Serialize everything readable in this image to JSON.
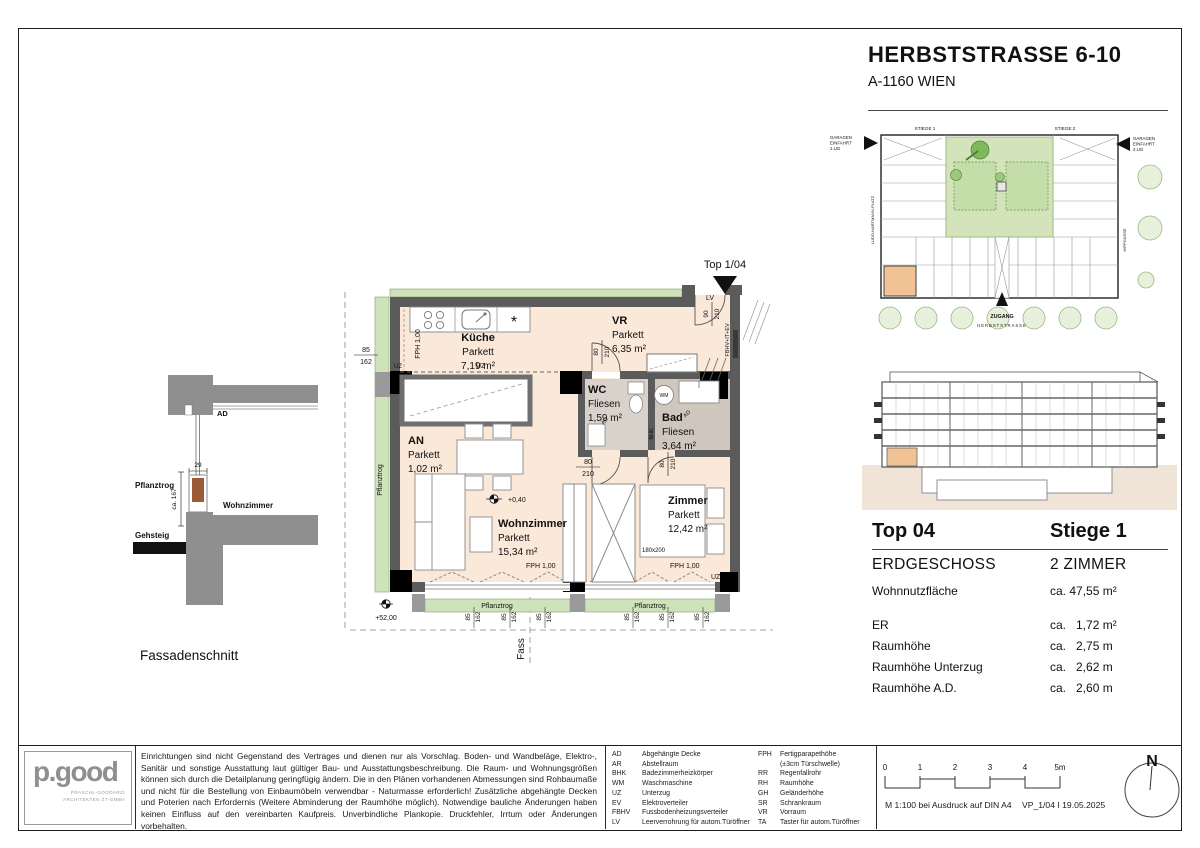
{
  "header": {
    "title": "HERBSTSTRASSE 6-10",
    "subtitle": "A-1160 WIEN"
  },
  "site_plan": {
    "stiege1": "STIEGE 1",
    "stiege2": "STIEGE 2",
    "garage_left": [
      "GARAGEN",
      "EINFAHRT",
      "1.UG"
    ],
    "garage_right": [
      "GARAGEN",
      "EINFAHRT",
      "2.UG"
    ],
    "street_left": "LUDO-HARTMANN-PLATZ",
    "street_right": "HIPPGASSE",
    "zugang": "ZUGANG",
    "street_bottom": "HERBSTSTRASSE"
  },
  "plan": {
    "unit_label": "Top 1/04",
    "rooms": {
      "kueche": {
        "name": "Küche",
        "floor": "Parkett",
        "area": "7,19 m²"
      },
      "vr": {
        "name": "VR",
        "floor": "Parkett",
        "area": "6,35 m²"
      },
      "wc": {
        "name": "WC",
        "floor": "Fliesen",
        "area": "1,59 m²"
      },
      "bad": {
        "name": "Bad",
        "floor": "Fliesen",
        "area": "3,64 m²"
      },
      "an": {
        "name": "AN",
        "floor": "Parkett",
        "area": "1,02 m²"
      },
      "wohnzimmer": {
        "name": "Wohnzimmer",
        "floor": "Parkett",
        "area": "15,34 m²"
      },
      "zimmer": {
        "name": "Zimmer",
        "floor": "Parkett",
        "area": "12,42 m²"
      }
    },
    "annotations": {
      "lv": "LV",
      "uz": "UZ",
      "fbhv": "FBHV+IT+EV",
      "fph": "FPH 1,00",
      "wm": "WM",
      "bhk": "BHK",
      "ad": "AD",
      "level": "+0,40",
      "ground": "+52,00",
      "bed_size": "180x200",
      "pflanztrog": "Pflanztrog",
      "fass": "Fass",
      "dim_w": "85",
      "dim_h": "162",
      "door_w": "80",
      "door_h": "210",
      "entry_w": "90",
      "appliance": "*"
    }
  },
  "facade": {
    "caption": "Fassadenschnitt",
    "ad": "AD",
    "pflanztrog": "Pflanztrog",
    "wohnzimmer": "Wohnzimmer",
    "gehsteig": "Gehsteig",
    "dim_width": "29",
    "dim_height": "ca. 167"
  },
  "info": {
    "top": "Top  04",
    "stiege": "Stiege 1",
    "floor": "ERDGESCHOSS",
    "rooms": "2 ZIMMER",
    "area_label": "Wohnnutzfläche",
    "area_value": "ca. 47,55 m²",
    "rows": [
      {
        "label": "ER",
        "value": "ca.   1,72 m²"
      },
      {
        "label": "Raumhöhe",
        "value": "ca.   2,75 m"
      },
      {
        "label": "Raumhöhe Unterzug",
        "value": "ca.   2,62 m"
      },
      {
        "label": "Raumhöhe A.D.",
        "value": "ca.   2,60 m"
      }
    ]
  },
  "footer": {
    "logo": {
      "word": "p.good",
      "line1": "PRASCHL-GOODARZI",
      "line2": "ARCHITEKTEN ZT-GMBH"
    },
    "disclaimer": "Einrichtungen sind nicht Gegenstand des Vertrages und dienen nur als Vorschlag. Boden- und Wandbeläge, Elektro-, Sanitär und sonstige Ausstattung laut gültiger Bau- und Ausstattungsbeschreibung. Die Raum- und Wohnungsgrößen können sich durch die Detailplanung geringfügig ändern. Die in den Plänen vorhandenen Abmessungen sind Rohbaumaße und nicht für die Bestellung von Einbaumöbeln verwendbar - Naturmasse erforderlich! Zusätzliche abgehängte Decken und Poterien nach Erfordernis (Weitere Abminderung der Raumhöhe möglich). Notwendige bauliche Änderungen haben keinen Einfluss auf den vereinbarten Kaufpreis. Unverbindliche Plankopie. Druckfehler, Irrtum oder Änderungen vorbehalten.",
    "abbr_left": [
      [
        "AD",
        "Abgehängte Decke"
      ],
      [
        "AR",
        "Abstellraum"
      ],
      [
        "BHK",
        "Badezimmerheizkörper"
      ],
      [
        "WM",
        "Waschmaschine"
      ],
      [
        "UZ",
        "Unterzug"
      ],
      [
        "EV",
        "Elektroverteiler"
      ],
      [
        "FBHV",
        "Fussbodenheizungsverteiler"
      ],
      [
        "LV",
        "Leerverrohrung für autom.Türöffner"
      ]
    ],
    "abbr_right": [
      [
        "FPH",
        "Fertigparapethöhe"
      ],
      [
        "",
        "(±3cm Türschwelle)"
      ],
      [
        "RR",
        "Regenfallrohr"
      ],
      [
        "RH",
        "Raumhöhe"
      ],
      [
        "GH",
        "Geländerhöhe"
      ],
      [
        "SR",
        "Schrankraum"
      ],
      [
        "VR",
        "Vorraum"
      ],
      [
        "TA",
        "Taster für autom.Türöffner"
      ]
    ],
    "scale": {
      "t0": "0",
      "t1": "1",
      "t2": "2",
      "t3": "3",
      "t4": "4",
      "t5": "5m",
      "note": "M 1:100 bei Ausdruck auf DIN A4",
      "version": "VP_1/04 I 19.05.2025"
    },
    "north": "N"
  }
}
